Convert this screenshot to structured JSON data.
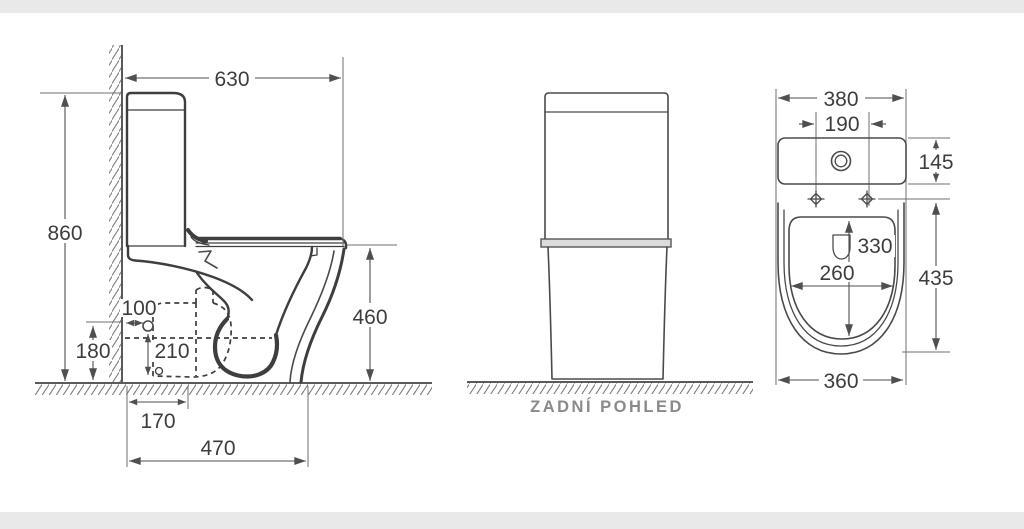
{
  "drawing": {
    "type": "technical-dimension-drawing",
    "subject": "close-coupled toilet (WC kombi)",
    "units": "mm",
    "colors": {
      "background": "#ffffff",
      "object_line": "#3e3e3e",
      "dimension_line": "#4f4f4f",
      "dimension_text": "#3d3d3d",
      "caption_text": "#8a8a8a",
      "hatch": "#808080",
      "edge_band": "#e9e9e9"
    }
  },
  "views": {
    "side": {
      "dims": {
        "overall_depth": "630",
        "overall_height": "860",
        "rim_height": "460",
        "inlet_from_wall": "100",
        "inlet_height": "180",
        "inlet_drop": "210",
        "outlet_from_wall": "170",
        "base_depth": "470"
      }
    },
    "rear": {
      "caption": "ZADNÍ POHLED"
    },
    "top": {
      "dims": {
        "overall_width": "380",
        "bolt_spacing": "190",
        "tank_depth": "145",
        "opening_length": "330",
        "opening_width": "260",
        "bowl_length": "435",
        "bowl_width": "360"
      }
    }
  }
}
